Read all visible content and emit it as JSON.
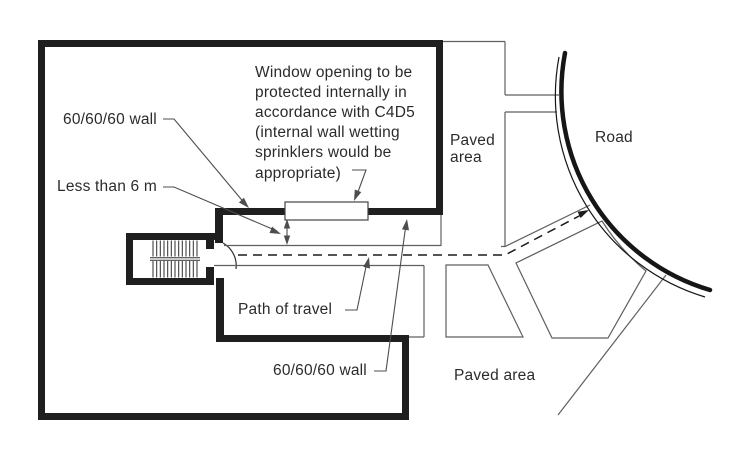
{
  "figure": {
    "description": "Site plan: path of travel from stair exit to road, window opening protection",
    "colors": {
      "background": "#ffffff",
      "wall": "#1f1f1f",
      "thin_line": "#5f5f5f",
      "leader": "#4d4d4d",
      "travel_dash": "#1c1c1c",
      "road_edge": "#161616",
      "stair_line": "#2e2e2e",
      "text": "#2b2b2b"
    }
  },
  "labels": {
    "wall_label_top": "60/60/60 wall",
    "distance_label": "Less than 6 m",
    "window_note_lines": [
      "Window opening to be",
      "protected internally in",
      "accordance with C4D5",
      "(internal wall wetting",
      "sprinklers would be",
      "appropriate)"
    ],
    "path_of_travel": "Path of travel",
    "wall_label_bottom": "60/60/60 wall",
    "paved_area_top_lines": [
      "Paved",
      "area"
    ],
    "road": "Road",
    "paved_area_bottom": "Paved area"
  }
}
